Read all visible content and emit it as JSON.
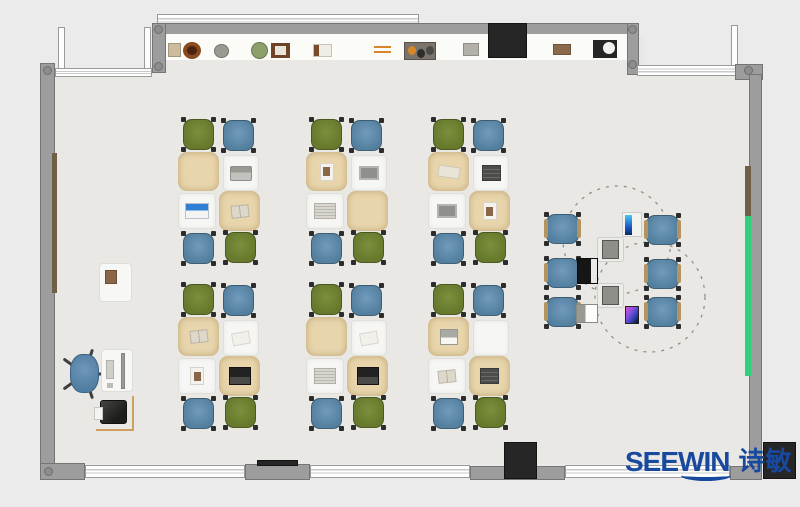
{
  "scene": {
    "w": 800,
    "h": 507,
    "bg": "#ebebeb",
    "floor": "#e9e8e4"
  },
  "palette": {
    "wall": "#9d9d9d",
    "wall_edge": "#757575",
    "window_bg": "#ffffff",
    "window_line": "#c9c9c9",
    "dark_block": "#262626",
    "shelf_band": "#fbfbf8",
    "accent_teal": "#31d17b",
    "accent_brown": "#6f6045",
    "chair_green": "#6e7f31",
    "chair_blue": "#5f88ae",
    "chair_foot": "#2c2c2c",
    "armrest": "#b5935f",
    "desk_tan": "#e8d5ac",
    "desk_white": "#f6f6f4",
    "dash": "#8f8f8a",
    "logo_blue": "#17499f"
  },
  "branding": {
    "logo_text": "SEEWIN",
    "logo_cjk": "诗敏"
  },
  "floor_rects": [
    {
      "name": "floor-top-strip",
      "x": 152,
      "y": 34,
      "w": 492,
      "h": 40
    },
    {
      "name": "floor-main",
      "x": 55,
      "y": 70,
      "w": 694,
      "h": 394
    }
  ],
  "walls": [
    {
      "name": "top-outer-window",
      "x": 157,
      "y": 14,
      "w": 262,
      "h": 13,
      "kind": "window"
    },
    {
      "name": "top-wall",
      "x": 152,
      "y": 23,
      "w": 487,
      "h": 12,
      "kind": "wall"
    },
    {
      "name": "top-wall-left-pier",
      "x": 152,
      "y": 23,
      "w": 14,
      "h": 50,
      "kind": "wall"
    },
    {
      "name": "top-wall-right-pier",
      "x": 627,
      "y": 23,
      "w": 12,
      "h": 52,
      "kind": "wall"
    },
    {
      "name": "shelf-band",
      "x": 166,
      "y": 34,
      "w": 461,
      "h": 26,
      "kind": "band"
    },
    {
      "name": "entry-frame-left",
      "x": 58,
      "y": 27,
      "w": 7,
      "h": 44,
      "kind": "window-v"
    },
    {
      "name": "entry-frame-right",
      "x": 144,
      "y": 27,
      "w": 7,
      "h": 44,
      "kind": "window-v"
    },
    {
      "name": "topleft-window-band",
      "x": 55,
      "y": 68,
      "w": 97,
      "h": 9,
      "kind": "window"
    },
    {
      "name": "left-wall",
      "x": 40,
      "y": 63,
      "w": 15,
      "h": 402,
      "kind": "wall"
    },
    {
      "name": "left-accent-board",
      "x": 52,
      "y": 153,
      "w": 5,
      "h": 140,
      "kind": "accent-brown"
    },
    {
      "name": "topright-frame",
      "x": 731,
      "y": 25,
      "w": 7,
      "h": 42,
      "kind": "window-v"
    },
    {
      "name": "topright-window-band",
      "x": 637,
      "y": 65,
      "w": 100,
      "h": 11,
      "kind": "window"
    },
    {
      "name": "topright-corner",
      "x": 735,
      "y": 64,
      "w": 28,
      "h": 16,
      "kind": "wall"
    },
    {
      "name": "right-wall",
      "x": 749,
      "y": 74,
      "w": 13,
      "h": 397,
      "kind": "wall"
    },
    {
      "name": "right-accent-brown",
      "x": 745,
      "y": 166,
      "w": 6,
      "h": 50,
      "kind": "accent-brown"
    },
    {
      "name": "right-accent-teal",
      "x": 745,
      "y": 216,
      "w": 6,
      "h": 160,
      "kind": "accent-teal"
    },
    {
      "name": "bottom-corner-left",
      "x": 40,
      "y": 463,
      "w": 45,
      "h": 17,
      "kind": "wall"
    },
    {
      "name": "bottom-window-a",
      "x": 85,
      "y": 465,
      "w": 160,
      "h": 13,
      "kind": "window"
    },
    {
      "name": "bottom-pier-a",
      "x": 245,
      "y": 464,
      "w": 65,
      "h": 16,
      "kind": "wall"
    },
    {
      "name": "bottom-dark-strip",
      "x": 257,
      "y": 460,
      "w": 41,
      "h": 6,
      "kind": "dark"
    },
    {
      "name": "bottom-window-b",
      "x": 310,
      "y": 465,
      "w": 160,
      "h": 13,
      "kind": "window"
    },
    {
      "name": "bottom-pier-b",
      "x": 470,
      "y": 466,
      "w": 95,
      "h": 14,
      "kind": "wall"
    },
    {
      "name": "bottom-door-block",
      "x": 504,
      "y": 442,
      "w": 33,
      "h": 37,
      "kind": "dark"
    },
    {
      "name": "bottom-window-c",
      "x": 565,
      "y": 465,
      "w": 165,
      "h": 13,
      "kind": "window"
    },
    {
      "name": "bottom-corner-right",
      "x": 730,
      "y": 466,
      "w": 32,
      "h": 14,
      "kind": "wall"
    },
    {
      "name": "outside-dark-block",
      "x": 763,
      "y": 442,
      "w": 33,
      "h": 37,
      "kind": "dark"
    },
    {
      "name": "wall-tv",
      "x": 488,
      "y": 23,
      "w": 39,
      "h": 35,
      "kind": "dark"
    }
  ],
  "corner_dots": [
    {
      "x": 154,
      "y": 25
    },
    {
      "x": 154,
      "y": 62
    },
    {
      "x": 628,
      "y": 25
    },
    {
      "x": 628,
      "y": 60
    },
    {
      "x": 744,
      "y": 66
    },
    {
      "x": 43,
      "y": 66
    },
    {
      "x": 44,
      "y": 467
    }
  ],
  "shelf_items": [
    {
      "name": "shelf-box",
      "shape": "rect",
      "x": 168,
      "y": 43,
      "w": 13,
      "h": 14,
      "color": "#cdbb9e"
    },
    {
      "name": "shelf-bowl",
      "shape": "ring",
      "x": 183,
      "y": 42,
      "w": 18,
      "h": 17,
      "color": "#8a4a1f"
    },
    {
      "name": "shelf-plate",
      "shape": "circle",
      "x": 214,
      "y": 44,
      "w": 15,
      "h": 14,
      "color": "#9a9a92"
    },
    {
      "name": "shelf-plant",
      "shape": "circle",
      "x": 251,
      "y": 42,
      "w": 17,
      "h": 17,
      "color": "#8ba06b"
    },
    {
      "name": "shelf-picture-frame",
      "shape": "frame",
      "x": 271,
      "y": 43,
      "w": 19,
      "h": 15,
      "color": "#6e4428"
    },
    {
      "name": "shelf-books",
      "shape": "book",
      "x": 313,
      "y": 44,
      "w": 19,
      "h": 13,
      "color": "#f0ede6"
    },
    {
      "name": "shelf-sticks",
      "shape": "lines",
      "x": 374,
      "y": 46,
      "w": 17,
      "h": 8,
      "color": "#d9862b"
    },
    {
      "name": "shelf-tray",
      "shape": "tray",
      "x": 404,
      "y": 42,
      "w": 32,
      "h": 18,
      "color": "#7a746b"
    },
    {
      "name": "shelf-device",
      "shape": "rect",
      "x": 463,
      "y": 43,
      "w": 16,
      "h": 13,
      "color": "#b3b0aa"
    },
    {
      "name": "shelf-box2",
      "shape": "rect",
      "x": 553,
      "y": 44,
      "w": 18,
      "h": 11,
      "color": "#8a6a4a"
    },
    {
      "name": "shelf-clock",
      "shape": "clock",
      "x": 593,
      "y": 40,
      "w": 24,
      "h": 18,
      "color": "#262626"
    }
  ],
  "classroom": {
    "cluster_layout": {
      "desks": [
        {
          "type": "tan",
          "dx": 0,
          "dy": 0,
          "w": 41,
          "h": 39
        },
        {
          "type": "white",
          "dx": 45,
          "dy": 3,
          "w": 36,
          "h": 36
        },
        {
          "type": "white",
          "dx": 0,
          "dy": 41,
          "w": 38,
          "h": 36
        },
        {
          "type": "tan",
          "dx": 41,
          "dy": 39,
          "w": 41,
          "h": 40
        }
      ],
      "chairs": [
        {
          "color": "green",
          "dx": 5,
          "dy": -33
        },
        {
          "color": "blue",
          "dx": 45,
          "dy": -32
        },
        {
          "color": "blue",
          "dx": 5,
          "dy": 81
        },
        {
          "color": "green",
          "dx": 47,
          "dy": 80
        }
      ],
      "chair_size": {
        "w": 31,
        "h": 31
      }
    },
    "origins": [
      {
        "x": 178,
        "y": 152
      },
      {
        "x": 306,
        "y": 152
      },
      {
        "x": 428,
        "y": 152
      },
      {
        "x": 178,
        "y": 317
      },
      {
        "x": 306,
        "y": 317
      },
      {
        "x": 428,
        "y": 317
      }
    ],
    "items": [
      [
        "none",
        "laptop-gray",
        "screen-laptop",
        "book-open"
      ],
      [
        "photo",
        "tablet",
        "newspaper",
        "none"
      ],
      [
        "paper-pen",
        "notebook-dark",
        "tablet",
        "photo"
      ],
      [
        "book-open",
        "paper",
        "photo",
        "laptop-dark"
      ],
      [
        "none",
        "paper",
        "newspaper",
        "laptop-dark"
      ],
      [
        "keyboard-paper",
        "none",
        "book-open",
        "notebook-dark"
      ]
    ]
  },
  "discussion": {
    "circles": [
      {
        "cx": 617,
        "cy": 240,
        "r": 54
      },
      {
        "cx": 650,
        "cy": 297,
        "r": 55
      }
    ],
    "chair_size": {
      "w": 33,
      "h": 30
    },
    "chairs": [
      {
        "x": 546,
        "y": 214
      },
      {
        "x": 646,
        "y": 215
      },
      {
        "x": 546,
        "y": 258
      },
      {
        "x": 646,
        "y": 259
      },
      {
        "x": 546,
        "y": 297
      },
      {
        "x": 646,
        "y": 297
      }
    ],
    "equipment": [
      {
        "type": "monitor-panel",
        "x": 622,
        "y": 212
      },
      {
        "type": "machine",
        "x": 597,
        "y": 237
      },
      {
        "type": "laptop-black",
        "x": 577,
        "y": 258
      },
      {
        "type": "machine",
        "x": 597,
        "y": 283
      },
      {
        "type": "laptop-white",
        "x": 576,
        "y": 304
      },
      {
        "type": "phone",
        "x": 625,
        "y": 306
      }
    ]
  },
  "teacher": {
    "side_desk": {
      "x": 99,
      "y": 263,
      "w": 33,
      "h": 39
    },
    "chair": {
      "x": 67,
      "y": 351,
      "w": 35,
      "h": 45
    },
    "desk": {
      "x": 101,
      "y": 349,
      "w": 32,
      "h": 43
    },
    "printer_desk": {
      "x": 96,
      "y": 396,
      "w": 38,
      "h": 35
    },
    "printer": {
      "x": 100,
      "y": 400,
      "w": 27,
      "h": 24
    }
  }
}
